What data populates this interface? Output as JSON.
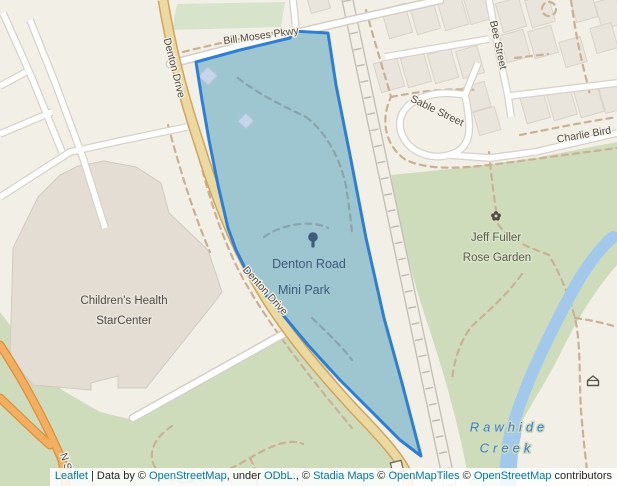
{
  "map": {
    "road_labels": {
      "bill_moses_pkwy": "Bill Moses Pkwy",
      "denton_drive_upper": "Denton Drive",
      "denton_drive_lower": "Denton Drive",
      "bee_street": "Bee Street",
      "sable_street": "Sable Street",
      "charlie_bird": "Charlie Bird",
      "n_stemmons_partial": "N St"
    },
    "place_labels": {
      "park_name_line1": "Denton Road",
      "park_name_line2": "Mini Park",
      "building_name_line1": "Children's Health",
      "building_name_line2": "StarCenter",
      "garden_name_line1": "Jeff Fuller",
      "garden_name_line2": "Rose Garden",
      "creek_name_line1": "Rawhide",
      "creek_name_line2": "Creek"
    },
    "colors": {
      "park_overlay_fill": "#9dc6d0",
      "park_overlay_stroke": "#2e7fd4",
      "water": "#a2c8ec",
      "greenspace": "#cfdcbc",
      "sports_field": "#d7e4cb",
      "land": "#f2efe7",
      "link_blue": "#0078A8"
    },
    "icons": {
      "tree_icon": "tree",
      "rose_icon": "flower",
      "shelter_icon": "shelter"
    }
  },
  "attribution": {
    "parts": [
      {
        "text": "Leaflet",
        "link": true
      },
      {
        "text": " | Data by © ",
        "link": false
      },
      {
        "text": "OpenStreetMap",
        "link": true
      },
      {
        "text": ", under ",
        "link": false
      },
      {
        "text": "ODbL.",
        "link": true
      },
      {
        "text": ", © ",
        "link": false
      },
      {
        "text": "Stadia Maps",
        "link": true
      },
      {
        "text": " © ",
        "link": false
      },
      {
        "text": "OpenMapTiles",
        "link": true
      },
      {
        "text": " © ",
        "link": false
      },
      {
        "text": "OpenStreetMap",
        "link": true
      },
      {
        "text": " contributors",
        "link": false
      }
    ]
  }
}
